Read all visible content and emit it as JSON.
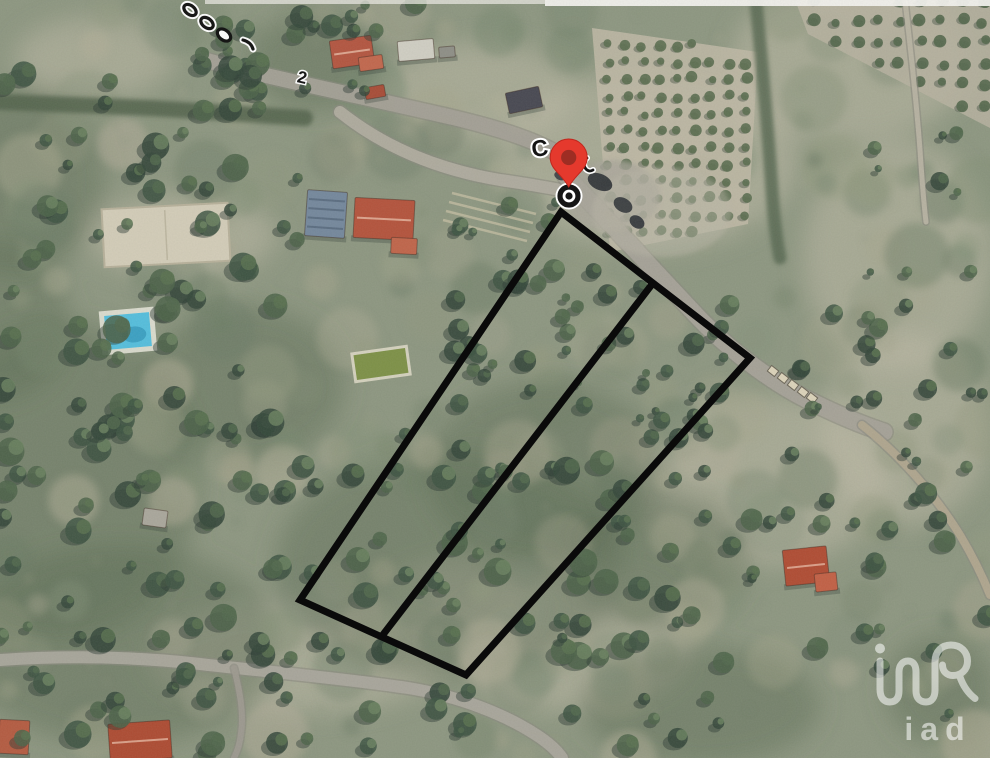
{
  "map": {
    "type": "satellite-aerial",
    "description": "Aerial view of a wooded hillside with olive groves, houses, roads, an outlined land parcel, a red location pin and an iad watermark",
    "road_label": "C",
    "road_label_secondary": "2",
    "watermark": {
      "text": "iad",
      "opacity": 0.55,
      "color": "#ffffff"
    },
    "colors": {
      "terrain_base": "#8d9680",
      "parcel_outline": "#0a0a0a",
      "pin_body": "#e5392d",
      "pin_inner": "#9e2d23",
      "marker_ring": "#161616",
      "marker_halo": "#ffffff",
      "road": "#a5a198",
      "label_text": "#141414",
      "label_halo": "#ffffff",
      "top_strip": "#f3f2ee"
    },
    "parcel": {
      "outline_vertices": [
        [
          561,
          212
        ],
        [
          750,
          358
        ],
        [
          466,
          675
        ],
        [
          300,
          600
        ]
      ],
      "divider_line": [
        [
          653,
          283
        ],
        [
          382,
          636
        ]
      ],
      "stroke_width": 7
    },
    "pin": {
      "x": 568.7,
      "tip_y": 187
    },
    "survey_marker": {
      "x": 569,
      "y": 196
    },
    "features": {
      "roads": [
        {
          "d": "M 205,60 C 270,78 360,96 455,118 C 505,130 540,142 563,157",
          "w": 15,
          "c": "#a4a096"
        },
        {
          "d": "M 340,112 C 385,148 440,170 500,180 C 528,184 550,188 566,191",
          "w": 12,
          "c": "#b0ac9f"
        },
        {
          "d": "M 566,176 C 602,214 646,262 696,315 C 728,349 770,381 808,400 C 840,416 862,425 884,432",
          "w": 17,
          "c": "#a6a298"
        },
        {
          "d": "M 862,425 C 900,455 935,495 960,535 C 972,555 982,575 990,595",
          "w": 8,
          "c": "#b1a78e"
        },
        {
          "d": "M 0,660 C 60,656 130,656 200,664 C 270,672 340,678 408,688 C 458,696 505,714 538,736 C 550,744 558,752 562,758",
          "w": 12,
          "c": "#aaa69c"
        },
        {
          "d": "M 234,668 C 240,692 244,714 241,733 C 240,744 237,752 234,758",
          "w": 6,
          "c": "#9d998f"
        },
        {
          "d": "M 905,0 C 910,45 916,95 920,150 C 922,180 924,205 926,222",
          "w": 5,
          "c": "#b8b3a2"
        }
      ],
      "dark_lane": {
        "d": "M 0,102 L 150,108 L 305,118",
        "w": 16,
        "c": "#51604b"
      },
      "hedge": {
        "d": "M 756,2 C 762,64 768,130 772,190 C 774,220 777,243 780,258",
        "w": 13,
        "c": "#586851"
      },
      "buildings": [
        {
          "cx": 352,
          "cy": 52,
          "w": 42,
          "h": 28,
          "rot": -8,
          "fill": "#b3543f",
          "ridge": true
        },
        {
          "cx": 371,
          "cy": 63,
          "w": 24,
          "h": 14,
          "rot": -8,
          "fill": "#c2664c"
        },
        {
          "cx": 416,
          "cy": 50,
          "w": 36,
          "h": 20,
          "rot": -5,
          "fill": "#d0cec3"
        },
        {
          "cx": 447,
          "cy": 52,
          "w": 16,
          "h": 11,
          "rot": -5,
          "fill": "#8e8e86"
        },
        {
          "cx": 375,
          "cy": 92,
          "w": 20,
          "h": 12,
          "rot": -10,
          "fill": "#a84b36"
        },
        {
          "cx": 524,
          "cy": 100,
          "w": 34,
          "h": 21,
          "rot": -12,
          "fill": "#474751"
        },
        {
          "cx": 326,
          "cy": 214,
          "w": 40,
          "h": 46,
          "rot": 4,
          "fill": "#74879c",
          "stripes": "#5a6c80"
        },
        {
          "cx": 384,
          "cy": 219,
          "w": 60,
          "h": 40,
          "rot": 3,
          "fill": "#b4523b",
          "ridge": true
        },
        {
          "cx": 404,
          "cy": 246,
          "w": 26,
          "h": 16,
          "rot": 3,
          "fill": "#c06449"
        },
        {
          "cx": 155,
          "cy": 518,
          "w": 24,
          "h": 17,
          "rot": 8,
          "fill": "#a9a69b"
        },
        {
          "cx": 806,
          "cy": 566,
          "w": 44,
          "h": 36,
          "rot": -6,
          "fill": "#b04b32",
          "ridge": true
        },
        {
          "cx": 826,
          "cy": 582,
          "w": 22,
          "h": 18,
          "rot": -6,
          "fill": "#c25f44"
        },
        {
          "cx": 140,
          "cy": 741,
          "w": 62,
          "h": 38,
          "rot": -4,
          "fill": "#ad4a31",
          "ridge": true
        },
        {
          "cx": 14,
          "cy": 737,
          "w": 30,
          "h": 34,
          "rot": 3,
          "fill": "#b45a40"
        }
      ],
      "court": {
        "cx": 166,
        "cy": 235,
        "w": 126,
        "h": 58,
        "rot": -3,
        "fill": "#d3ccb8",
        "edge": "#b7b09a"
      },
      "pool": {
        "cx": 128,
        "cy": 331,
        "w": 45,
        "h": 34,
        "rot": -5,
        "water": "#54bedd",
        "deck": "#e9e7dc",
        "deep": "#2f93b8"
      },
      "basin": {
        "cx": 381,
        "cy": 364,
        "w": 52,
        "h": 25,
        "rot": -8,
        "water": "#7d9046",
        "rim": "#dbd7c4"
      },
      "vehicles": [
        {
          "cx": 600,
          "cy": 182,
          "rx": 13,
          "ry": 8,
          "rot": 25,
          "fill": "#2e3135"
        },
        {
          "cx": 623,
          "cy": 205,
          "rx": 10,
          "ry": 7,
          "rot": 30,
          "fill": "#33363b"
        },
        {
          "cx": 637,
          "cy": 222,
          "rx": 8,
          "ry": 6,
          "rot": 35,
          "fill": "#2f3237"
        },
        {
          "cx": 560,
          "cy": 176,
          "rx": 6,
          "ry": 4,
          "rot": 25,
          "fill": "#3a3d41"
        }
      ],
      "road_objects": [
        {
          "cx": 773,
          "cy": 371
        },
        {
          "cx": 783,
          "cy": 378
        },
        {
          "cx": 793,
          "cy": 385
        },
        {
          "cx": 803,
          "cy": 392
        },
        {
          "cx": 812,
          "cy": 398
        }
      ],
      "groves": [
        {
          "poly": [
            [
              592,
              28
            ],
            [
              758,
              52
            ],
            [
              748,
              224
            ],
            [
              610,
              252
            ]
          ],
          "soil": "#bfb9a6",
          "spacing": 17,
          "r": 4.5,
          "dot": "#5a6d4f"
        },
        {
          "poly": [
            [
              795,
              0
            ],
            [
              990,
              0
            ],
            [
              990,
              128
            ],
            [
              808,
              34
            ]
          ],
          "soil": "#b7b1a0",
          "spacing": 21,
          "r": 5,
          "dot": "#53664b"
        }
      ],
      "terraces": [
        {
          "x1": 452,
          "y1": 193,
          "x2": 536,
          "y2": 214
        },
        {
          "x1": 449,
          "y1": 202,
          "x2": 533,
          "y2": 223
        },
        {
          "x1": 446,
          "y1": 211,
          "x2": 530,
          "y2": 232
        },
        {
          "x1": 443,
          "y1": 220,
          "x2": 527,
          "y2": 241
        }
      ],
      "light_patches": [
        [
          650,
          160,
          150,
          90
        ],
        [
          850,
          62,
          120,
          80
        ],
        [
          898,
          255,
          95,
          115
        ],
        [
          760,
          480,
          130,
          85
        ],
        [
          480,
          92,
          95,
          50
        ],
        [
          182,
          236,
          95,
          42
        ],
        [
          300,
          658,
          150,
          55
        ],
        [
          95,
          58,
          80,
          40
        ],
        [
          570,
          640,
          120,
          70
        ],
        [
          905,
          430,
          85,
          95
        ],
        [
          460,
          610,
          80,
          50
        ]
      ],
      "dark_patches": [
        [
          60,
          480,
          140,
          160
        ],
        [
          120,
          645,
          160,
          100
        ],
        [
          450,
          565,
          175,
          115
        ],
        [
          20,
          180,
          85,
          95
        ],
        [
          545,
          470,
          120,
          90
        ],
        [
          245,
          385,
          100,
          80
        ],
        [
          700,
          706,
          120,
          60
        ],
        [
          315,
          62,
          65,
          50
        ],
        [
          940,
          690,
          55,
          55
        ],
        [
          0,
          320,
          70,
          80
        ],
        [
          660,
          560,
          90,
          70
        ]
      ]
    }
  }
}
